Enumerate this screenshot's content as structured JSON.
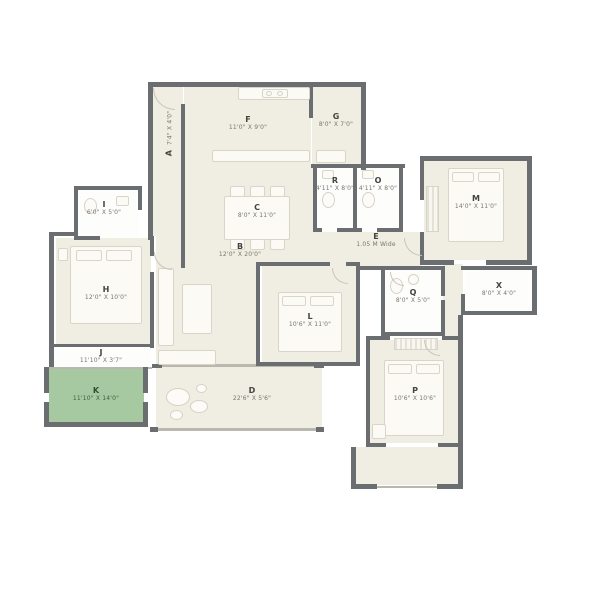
{
  "plan_title": "Apartment Floor Plan",
  "palette": {
    "wall": "#6b6e71",
    "floor": "#f0eee3",
    "bath_floor": "#fdfdfb",
    "garden_green": "#a7c9a2",
    "furniture": "#fbfaf5",
    "text": "#44443f"
  },
  "rooms": [
    {
      "label": "A",
      "dim": "7'4\" X 4'0\"",
      "type": "entry-foyer"
    },
    {
      "label": "F",
      "dim": "11'0\" X 9'0\"",
      "type": "kitchen"
    },
    {
      "label": "G",
      "dim": "8'0\" X 7'0\"",
      "type": "utility"
    },
    {
      "label": "C",
      "dim": "8'0\" X 11'0\"",
      "type": "dining"
    },
    {
      "label": "B",
      "dim": "12'0\" X 20'0\"",
      "type": "living"
    },
    {
      "label": "I",
      "dim": "6'0\" X 5'0\"",
      "type": "toilet"
    },
    {
      "label": "H",
      "dim": "12'0\" X 10'0\"",
      "type": "bedroom"
    },
    {
      "label": "J",
      "dim": "11'10\" X 3'7\"",
      "type": "passage"
    },
    {
      "label": "K",
      "dim": "11'10\" X 14'0\"",
      "type": "garden-balcony"
    },
    {
      "label": "D",
      "dim": "22'6\" X 5'6\"",
      "type": "deck"
    },
    {
      "label": "L",
      "dim": "10'6\" X 11'0\"",
      "type": "bedroom"
    },
    {
      "label": "R",
      "dim": "4'11\" X 8'0\"",
      "type": "toilet"
    },
    {
      "label": "O",
      "dim": "4'11\" X 8'0\"",
      "type": "toilet"
    },
    {
      "label": "E",
      "dim": "1.05 M Wide",
      "type": "passage"
    },
    {
      "label": "M",
      "dim": "14'0\" X 11'0\"",
      "type": "bedroom"
    },
    {
      "label": "Q",
      "dim": "8'0\" X 5'0\"",
      "type": "toilet"
    },
    {
      "label": "X",
      "dim": "8'0\" X 4'0\"",
      "type": "dress"
    },
    {
      "label": "P",
      "dim": "10'6\" X 10'6\"",
      "type": "bedroom"
    }
  ]
}
